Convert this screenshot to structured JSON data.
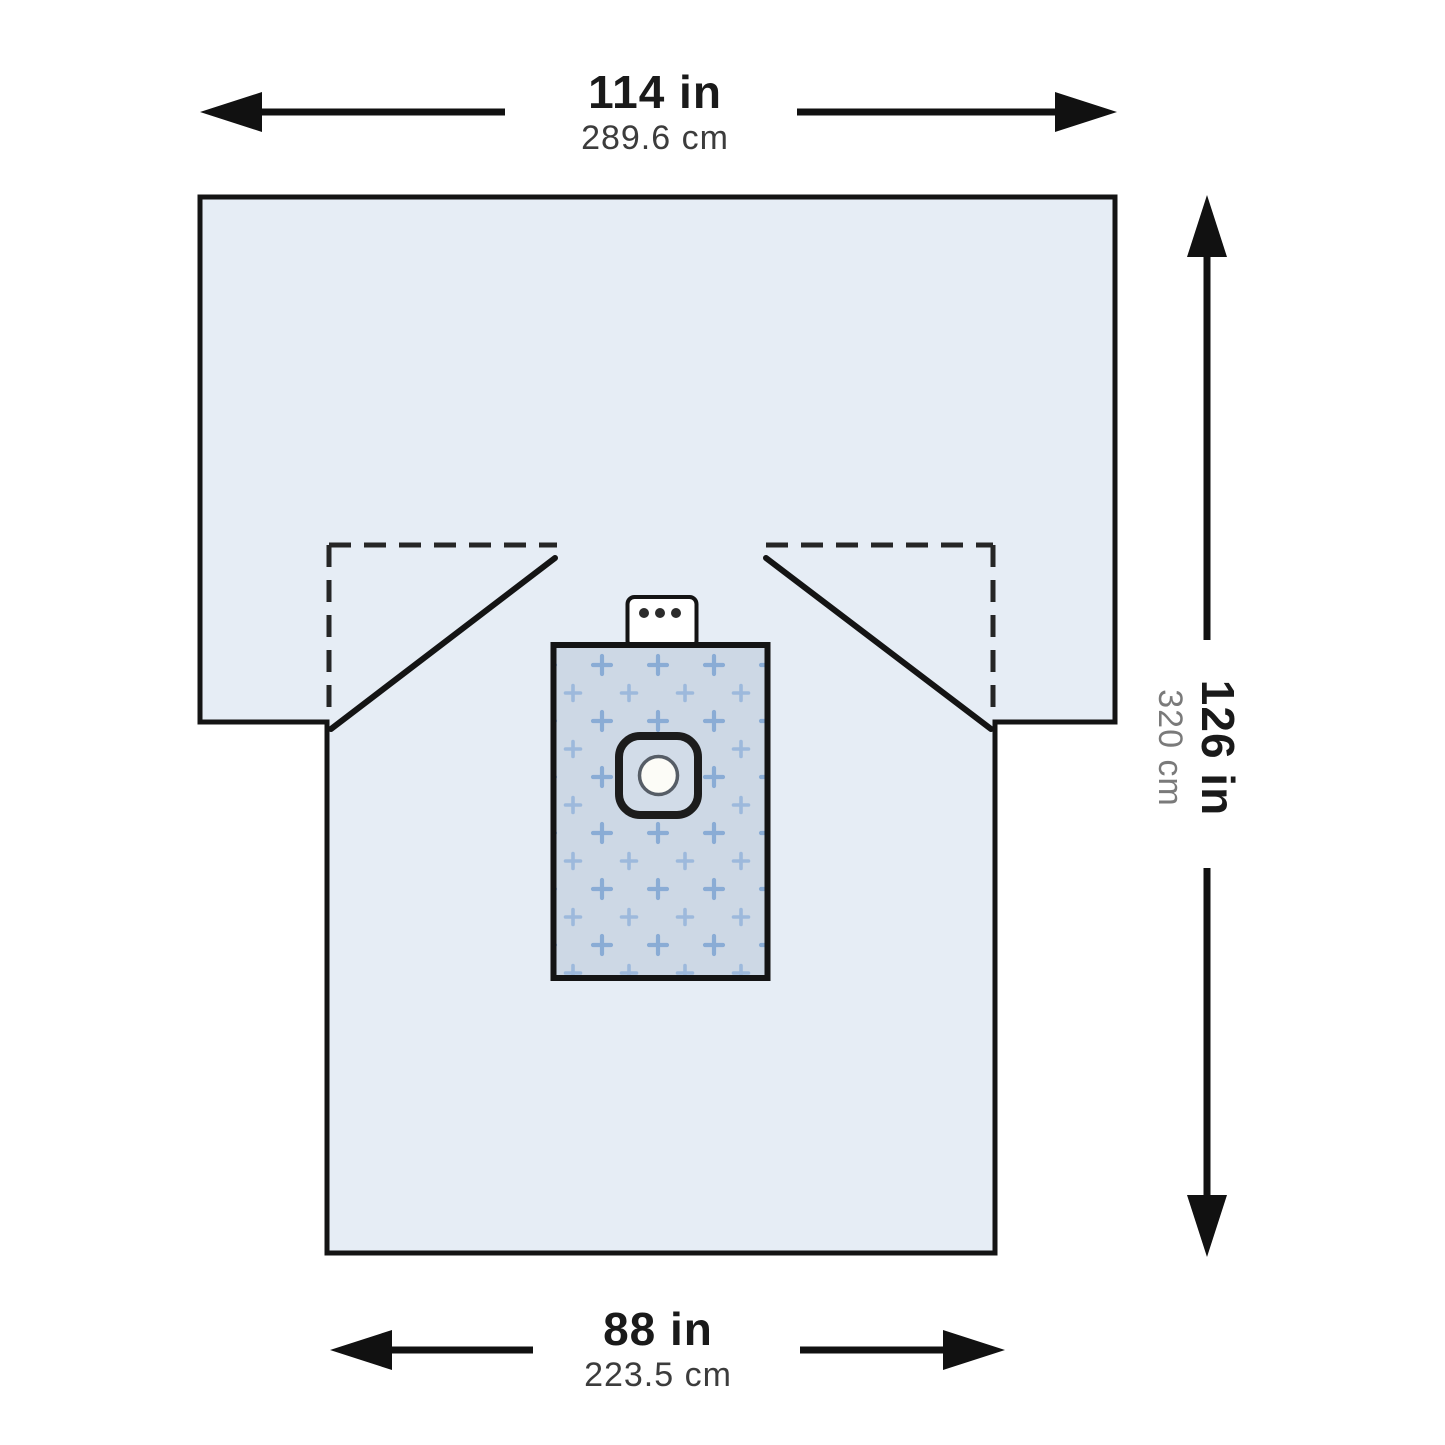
{
  "diagram": {
    "subject": "surgical-drape-dimension-diagram",
    "top_width": {
      "inches": "114 in",
      "centimeters": "289.6 cm"
    },
    "side_length": {
      "inches": "126 in",
      "centimeters": "320 cm"
    },
    "bottom_width": {
      "inches": "88 in",
      "centimeters": "223.5 cm"
    },
    "colors": {
      "outline": "#141414",
      "drape_fill": "#e6edf5",
      "fenestration_panel_fill": "#cdd8e5",
      "plus_mark_large": "#8aacd5",
      "plus_mark_small": "#9db9dc",
      "tab_fill": "#ffffff",
      "tab_dot": "#2b2b2b",
      "port_ring_fill": "#d2dce8",
      "port_circle_fill": "#fcfcf7"
    }
  }
}
